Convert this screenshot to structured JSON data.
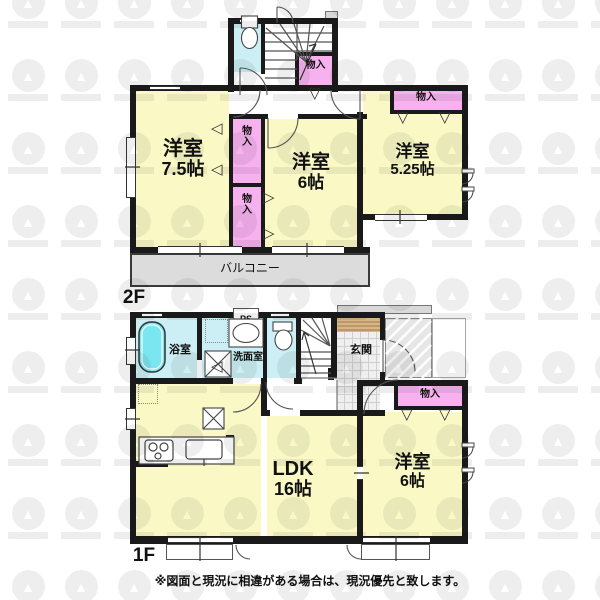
{
  "second_floor": {
    "floor_label": "2F",
    "bedroom_75": {
      "type": "洋室",
      "size": "7.5帖"
    },
    "bedroom_6": {
      "type": "洋室",
      "size": "6帖"
    },
    "bedroom_525": {
      "type": "洋室",
      "size": "5.25帖"
    },
    "closet": "物入",
    "balcony": "バルコニー"
  },
  "first_floor": {
    "floor_label": "1F",
    "ldk": {
      "type": "LDK",
      "size": "16帖"
    },
    "bedroom_6": {
      "type": "洋室",
      "size": "6帖"
    },
    "bath": "浴室",
    "washroom": "洗面室",
    "entrance": "玄関",
    "pipe_space": "PS",
    "closet": "物入"
  },
  "footnote": "※図面と現況に相違がある場合は、現況優先と致します。",
  "icons": {
    "watermark": "▲",
    "triangle_left": "◁",
    "triangle_right": "▷",
    "triangle_down": "▽"
  },
  "colors": {
    "room": "#faf9c6",
    "closet": "#f7b1ee",
    "wet_area": "#cbeff4",
    "bathtub": "#7be6ef",
    "balcony": "#dcdcdc",
    "wall": "#1a1a1a"
  }
}
